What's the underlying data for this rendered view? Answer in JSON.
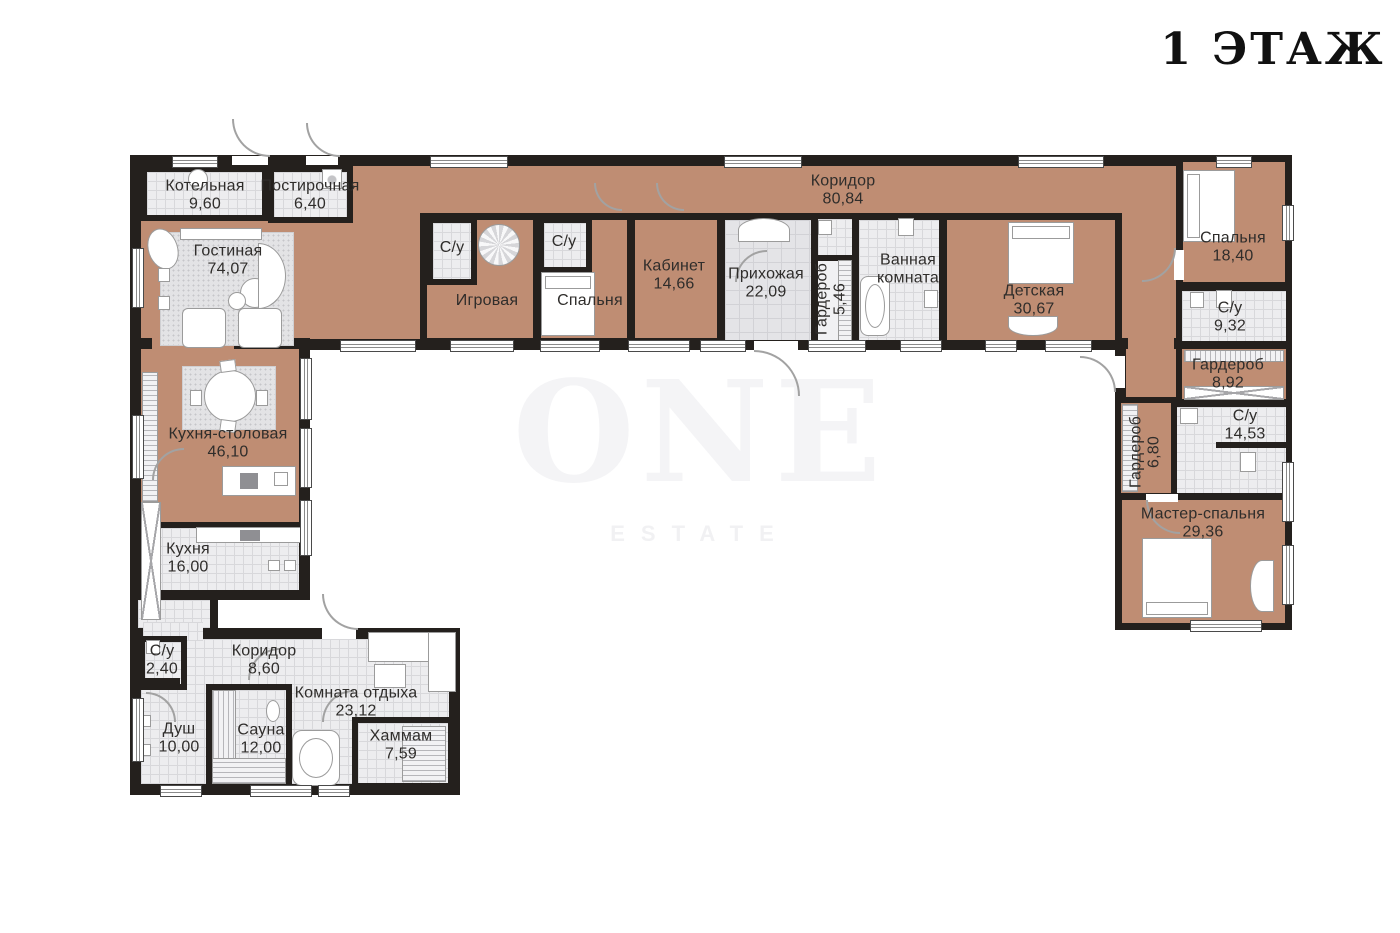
{
  "title": "1 ЭТАЖ",
  "watermark": {
    "line1": "ONE",
    "line2": "ESTATE"
  },
  "colors": {
    "wall": "#24201d",
    "tan": "#bf8d73",
    "tile": "#ededef",
    "ink": "#2f2d2b"
  },
  "rooms": [
    {
      "name": "Котельная",
      "area": "9,60"
    },
    {
      "name": "Постирочная",
      "area": "6,40"
    },
    {
      "name": "Гостиная",
      "area": "74,07"
    },
    {
      "name": "Коридор",
      "area": "80,84"
    },
    {
      "name": "С/у",
      "area": ""
    },
    {
      "name": "Игровая",
      "area": ""
    },
    {
      "name": "С/у",
      "area": ""
    },
    {
      "name": "Спальня",
      "area": ""
    },
    {
      "name": "Кабинет",
      "area": "14,66"
    },
    {
      "name": "Прихожая",
      "area": "22,09"
    },
    {
      "name": "Гардероб",
      "area": "5,46"
    },
    {
      "name": "Ванная комната",
      "area": ""
    },
    {
      "name": "Детская",
      "area": "30,67"
    },
    {
      "name": "Спальня",
      "area": "18,40"
    },
    {
      "name": "С/у",
      "area": "9,32"
    },
    {
      "name": "Гардероб",
      "area": "8,92"
    },
    {
      "name": "С/у",
      "area": "14,53"
    },
    {
      "name": "Гардероб",
      "area": "6,80"
    },
    {
      "name": "Мастер-спальня",
      "area": "29,36"
    },
    {
      "name": "Кухня-столовая",
      "area": "46,10"
    },
    {
      "name": "Кухня",
      "area": "16,00"
    },
    {
      "name": "С/у",
      "area": "2,40"
    },
    {
      "name": "Коридор",
      "area": "8,60"
    },
    {
      "name": "Душ",
      "area": "10,00"
    },
    {
      "name": "Сауна",
      "area": "12,00"
    },
    {
      "name": "Комната отдыха",
      "area": "23,12"
    },
    {
      "name": "Хаммам",
      "area": "7,59"
    }
  ]
}
